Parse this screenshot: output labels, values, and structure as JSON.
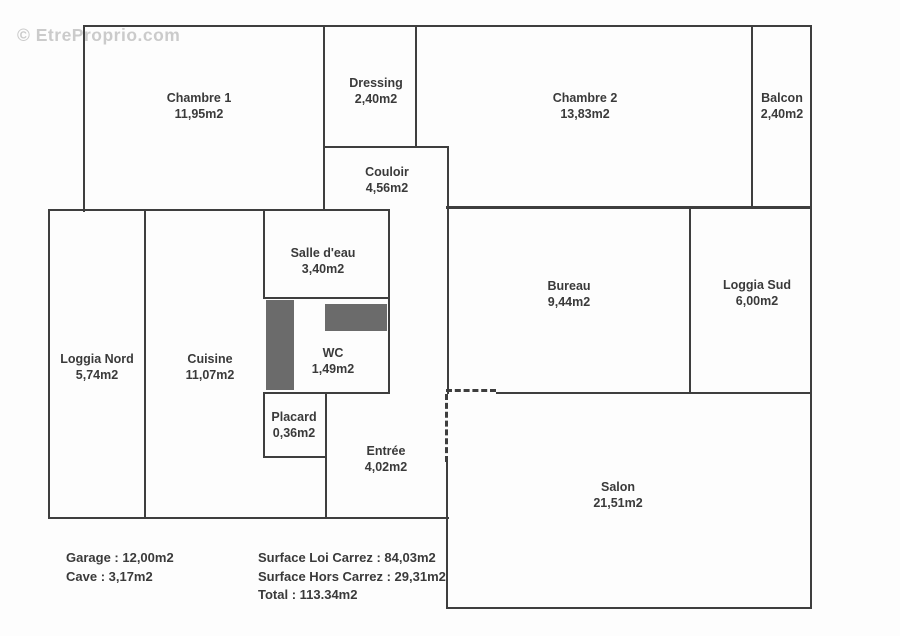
{
  "watermark": "© EtreProprio.com",
  "rooms": [
    {
      "id": "chambre-1",
      "name": "Chambre 1",
      "area": "11,95m2"
    },
    {
      "id": "dressing",
      "name": "Dressing",
      "area": "2,40m2"
    },
    {
      "id": "chambre-2",
      "name": "Chambre 2",
      "area": "13,83m2"
    },
    {
      "id": "balcon",
      "name": "Balcon",
      "area": "2,40m2"
    },
    {
      "id": "couloir",
      "name": "Couloir",
      "area": "4,56m2"
    },
    {
      "id": "salle-deau",
      "name": "Salle d'eau",
      "area": "3,40m2"
    },
    {
      "id": "bureau",
      "name": "Bureau",
      "area": "9,44m2"
    },
    {
      "id": "loggia-sud",
      "name": "Loggia Sud",
      "area": "6,00m2"
    },
    {
      "id": "loggia-nord",
      "name": "Loggia Nord",
      "area": "5,74m2"
    },
    {
      "id": "cuisine",
      "name": "Cuisine",
      "area": "11,07m2"
    },
    {
      "id": "wc",
      "name": "WC",
      "area": "1,49m2"
    },
    {
      "id": "placard",
      "name": "Placard",
      "area": "0,36m2"
    },
    {
      "id": "entree",
      "name": "Entrée",
      "area": "4,02m2"
    },
    {
      "id": "salon",
      "name": "Salon",
      "area": "21,51m2"
    }
  ],
  "summary": {
    "left": [
      "Garage : 12,00m2",
      "Cave : 3,17m2"
    ],
    "right": [
      "Surface Loi Carrez : 84,03m2",
      "Surface Hors Carrez : 29,31m2",
      "Total : 113.34m2"
    ]
  },
  "colors": {
    "wall": "#3e3e3e",
    "ink": "#3a3a3a",
    "block": "#6b6b6b",
    "watermark": "#cbcbcb",
    "background": "#fdfdfd"
  }
}
